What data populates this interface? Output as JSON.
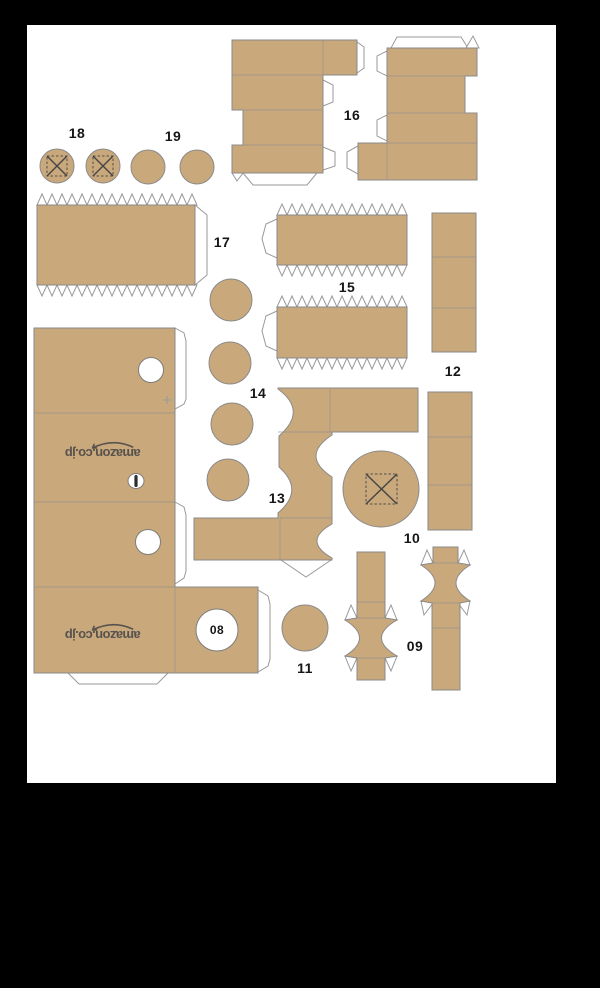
{
  "sheet": {
    "background": "#000000",
    "paper": "#ffffff"
  },
  "colors": {
    "cardboard": "#c9a87b",
    "outline": "#8a8a8a",
    "flap": "#ffffff",
    "label": "#161616",
    "logo": "#58524e"
  },
  "logo": {
    "text": "amazon.co.jp"
  },
  "labels": {
    "l08": "08",
    "l09": "09",
    "l10": "10",
    "l11": "11",
    "l12": "12",
    "l13": "13",
    "l14": "14",
    "l15": "15",
    "l16": "16",
    "l17": "17",
    "l18": "18",
    "l19": "19"
  }
}
